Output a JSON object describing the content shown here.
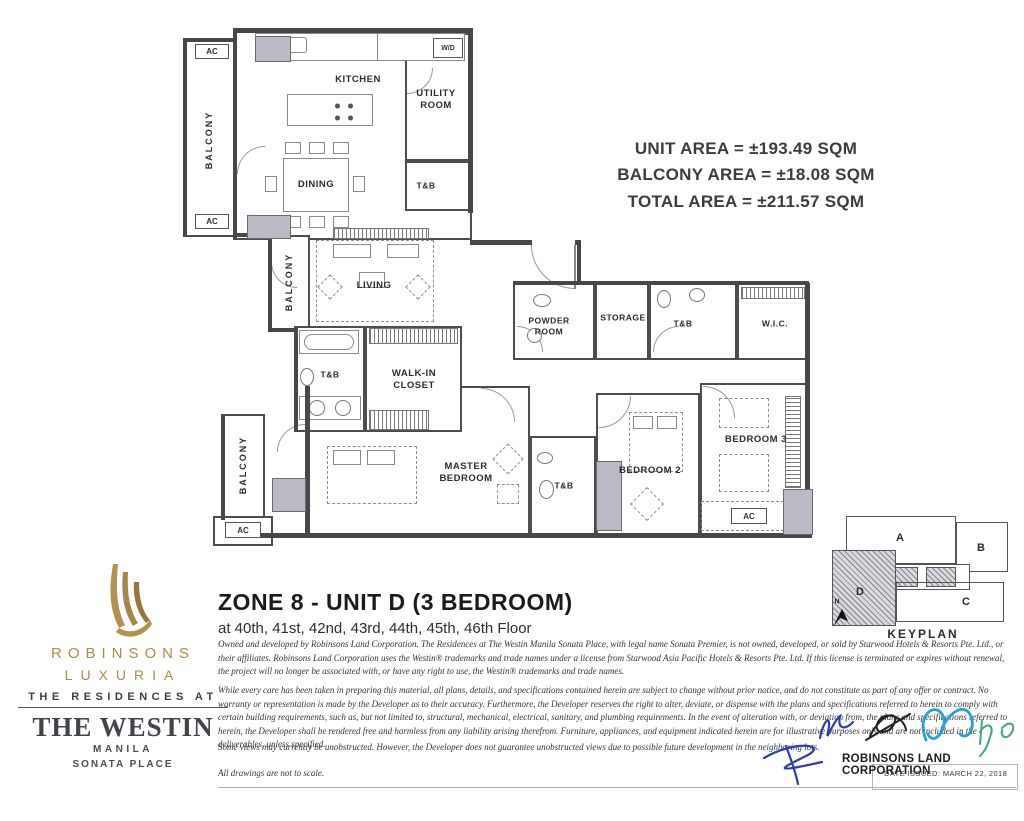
{
  "area": {
    "lines": [
      "UNIT AREA = ±193.49 SQM",
      "BALCONY AREA = ±18.08 SQM",
      "TOTAL AREA = ±211.57 SQM"
    ]
  },
  "floorplan": {
    "labels": {
      "kitchen": "KITCHEN",
      "dining": "DINING",
      "utility": "UTILITY\nROOM",
      "tnb": "T&B",
      "balcony": "BALCONY",
      "living": "LIVING",
      "walk_in_closet": "WALK-IN\nCLOSET",
      "powder_room": "POWDER\nROOM",
      "storage": "STORAGE",
      "wic": "W.I.C.",
      "master_bedroom": "MASTER\nBEDROOM",
      "bedroom2": "BEDROOM 2",
      "bedroom3": "BEDROOM 3",
      "ac": "AC",
      "wd": "W/D"
    }
  },
  "keyplan": {
    "title": "KEYPLAN",
    "north": "N",
    "units": [
      "A",
      "B",
      "C",
      "D"
    ],
    "highlighted_unit": "D"
  },
  "brand": {
    "name_line1": "ROBINSONS",
    "name_line2": "LUXURIA",
    "residences_at": "THE RESIDENCES AT",
    "hotel": "THE WESTIN",
    "city": "MANILA",
    "property": "SONATA PLACE"
  },
  "titleblock": {
    "title": "ZONE 8 - UNIT D (3 BEDROOM)",
    "floors": "at 40th, 41st, 42nd, 43rd, 44th, 45th, 46th Floor"
  },
  "legal": {
    "para1": "Owned and developed by Robinsons Land Corporation. The Residences at The Westin Manila Sonata Place, with legal name Sonata Premier, is not owned, developed, or sold by Starwood Hotels & Resorts Pte. Ltd., or their affiliates. Robinsons Land Corporation uses the Westin® trademarks and trade names under a license from Starwood Asia Pacific Hotels & Resorts Pte. Ltd. If this license is terminated or expires without renewal, the project will no longer be associated with, or have any right to use, the Westin® trademarks and trade names.",
    "para2": "While every care has been taken in preparing this material, all plans, details, and specifications contained herein are subject to change without prior notice, and do not constitute as part of any offer or contract. No warranty or representation is made by the Developer as to their accuracy. Furthermore, the Developer reserves the right to alter, deviate, or dispense with the plans and specifications referred to herein to comply with certain building requirements, such as, but not limited to, structural, mechanical, electrical, sanitary, and plumbing requirements. In the event of alteration with, or deviation from, the plans and specifications referred to herein, the Developer shall be rendered free and harmless from any liability arising therefrom. Furniture, appliances, and equipment indicated herein are for illustrative purposes only and are not included in the deliverables, unless specified.",
    "para3": "Some views may currently be unobstructed. However, the Developer does not guarantee unobstructed views due to possible future development in the neighboring lots.",
    "para4": "All drawings are not to scale."
  },
  "signature": {
    "company": "ROBINSONS LAND CORPORATION",
    "date_issued": "DATE ISSUED: MARCH 22, 2018"
  },
  "colors": {
    "brand_gold": "#a98c4e",
    "ink": "#3b4046",
    "wall": "#474747",
    "column": "#b9bac4",
    "sig_blue": "#2b3db5",
    "sig_cyan": "#2d9fd6",
    "sig_green": "#3da87a",
    "sig_black": "#222222"
  }
}
